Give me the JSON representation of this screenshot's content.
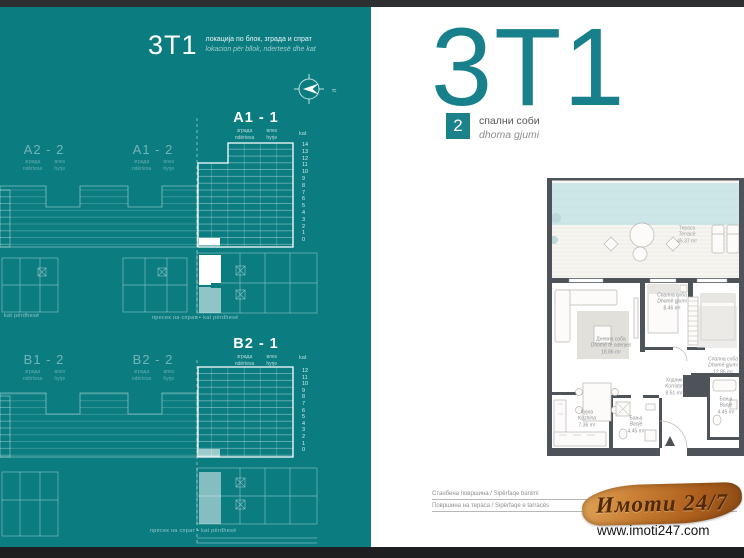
{
  "left_panel": {
    "code": "3T1",
    "subtitle_mk": "локација по блок, зграда и спрат",
    "subtitle_sq": "lokacion për bllok, ndertesë dhe kat",
    "compass_mark": "≈",
    "sub_building_mk": "зграда",
    "sub_building_sq": "ndërtesa",
    "sub_entrance_mk": "влез",
    "sub_entrance_sq": "hyrje",
    "kat_label": "kat",
    "floors_a": [
      "14",
      "13",
      "12",
      "11",
      "10",
      "9",
      "8",
      "7",
      "6",
      "5",
      "4",
      "3",
      "2",
      "1",
      "0"
    ],
    "floors_b": [
      "12",
      "11",
      "10",
      "9",
      "8",
      "7",
      "6",
      "5",
      "4",
      "3",
      "2",
      "1",
      "0"
    ],
    "units": {
      "a2_2": "A2 - 2",
      "a1_2": "A1 - 2",
      "a1_1": "A1 - 1",
      "b1_2": "B1 - 2",
      "b2_2": "B2 - 2",
      "b2_1": "B2 - 1"
    },
    "captions": {
      "ground": "kat përdhesë",
      "section": "пресек на спрат ▪ kat përdhesë"
    }
  },
  "right_panel": {
    "code": "3T1",
    "bedrooms": {
      "count": "2",
      "label_mk": "спални соби",
      "label_sq": "dhoma gjumi"
    },
    "rooms": [
      {
        "mk": "Тераса",
        "sq": "Terracë",
        "area": "45.37 m²"
      },
      {
        "mk": "Дневна соба",
        "sq": "Dhomë të ndenjes",
        "area": "18.86 m²"
      },
      {
        "mk": "Спална соба",
        "sq": "Dhomë gjumi",
        "area": "8.46 m²"
      },
      {
        "mk": "Спална соба",
        "sq": "Dhomë gjumi",
        "area": "12.86 m²"
      },
      {
        "mk": "Ходник",
        "sq": "Korridor",
        "area": "8.61 m²"
      },
      {
        "mk": "Кујна",
        "sq": "Kuzhina",
        "area": "7.36 m²"
      },
      {
        "mk": "Бања",
        "sq": "Banjë",
        "area": "4.45 m²"
      },
      {
        "mk": "Бања",
        "sq": "Banjë",
        "area": "4.45 m²"
      }
    ],
    "footer": {
      "living_area": "Станбена површина / Sipërfaqe banimi",
      "terrace_area": "Површина на тераса / Sipërfaqe e tarracës"
    },
    "watermark": {
      "brand": "Имоти 24/7",
      "url": "www.imoti247.com"
    }
  }
}
